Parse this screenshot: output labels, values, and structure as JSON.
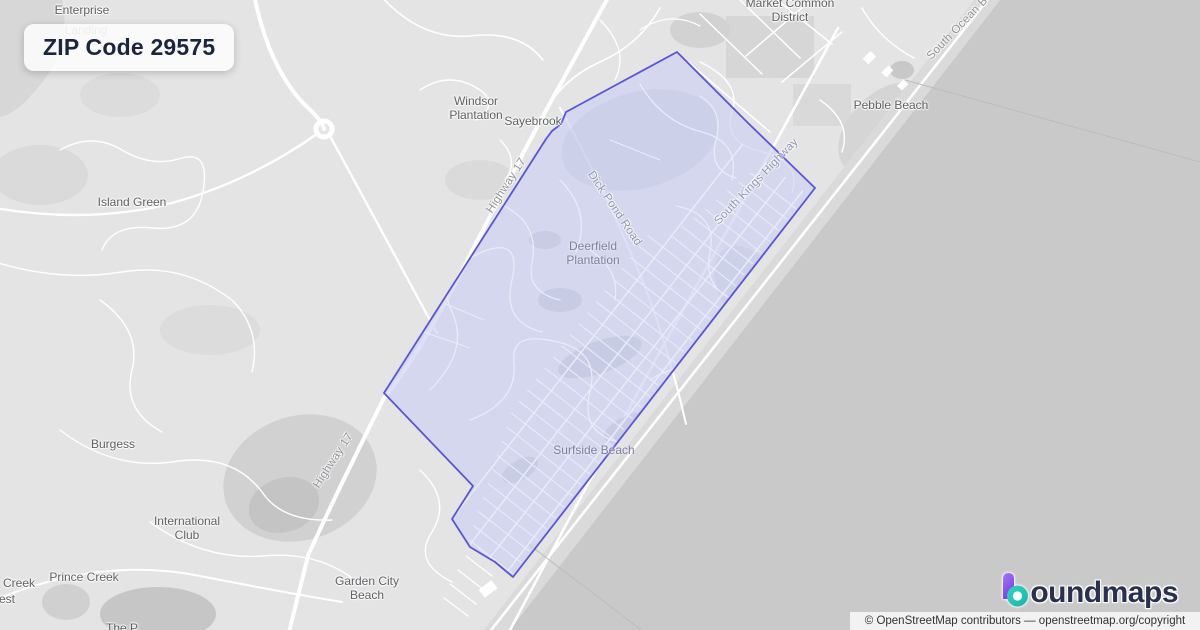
{
  "badge": {
    "title": "ZIP Code 29575"
  },
  "brand": {
    "wordmark": "oundmaps",
    "full_name": "boundmaps",
    "logo_colors": {
      "purple_top": "#a07cf0",
      "purple_bottom": "#7a3bea",
      "teal_light": "#35d3c0",
      "teal_dark": "#1db3ac"
    }
  },
  "attribution": {
    "text": "© OpenStreetMap contributors — openstreetmap.org/copyright"
  },
  "map": {
    "colors": {
      "land": "#e4e4e4",
      "ocean": "#c9c9c9",
      "beach": "#dadada",
      "road": "#ffffff",
      "zip_fill": "rgba(203,208,242,0.66)",
      "zip_border": "#5a55d8"
    },
    "zip_boundary_points": [
      [
        677,
        52
      ],
      [
        746,
        121
      ],
      [
        815,
        188
      ],
      [
        513,
        577
      ],
      [
        495,
        562
      ],
      [
        470,
        547
      ],
      [
        452,
        519
      ],
      [
        473,
        486
      ],
      [
        384,
        393
      ],
      [
        546,
        139
      ],
      [
        552,
        131
      ],
      [
        561,
        124
      ],
      [
        566,
        112
      ]
    ],
    "labels": [
      {
        "id": "enterprise",
        "text": "Enterprise",
        "x": 82,
        "y": 11,
        "rot": 0,
        "cls": ""
      },
      {
        "id": "landing",
        "text": "Landing",
        "x": 86,
        "y": 31,
        "rot": 0,
        "cls": "lbl-faded"
      },
      {
        "id": "windsor-plantation",
        "text": "Windsor\nPlantation",
        "x": 476,
        "y": 109,
        "rot": 0,
        "cls": ""
      },
      {
        "id": "sayebrook",
        "text": "Sayebrook",
        "x": 533,
        "y": 122,
        "rot": 0,
        "cls": ""
      },
      {
        "id": "market-common-district",
        "text": "Market Common\nDistrict",
        "x": 790,
        "y": 11,
        "rot": 0,
        "cls": ""
      },
      {
        "id": "pebble-beach",
        "text": "Pebble Beach",
        "x": 891,
        "y": 106,
        "rot": 0,
        "cls": ""
      },
      {
        "id": "island-green",
        "text": "Island Green",
        "x": 132,
        "y": 203,
        "rot": 0,
        "cls": ""
      },
      {
        "id": "deerfield-plantation",
        "text": "Deerfield\nPlantation",
        "x": 593,
        "y": 254,
        "rot": 0,
        "cls": "lbl-inpoly"
      },
      {
        "id": "surfside-beach",
        "text": "Surfside Beach",
        "x": 594,
        "y": 451,
        "rot": 0,
        "cls": "lbl-inpoly"
      },
      {
        "id": "burgess",
        "text": "Burgess",
        "x": 113,
        "y": 445,
        "rot": 0,
        "cls": ""
      },
      {
        "id": "international-club",
        "text": "International\nClub",
        "x": 187,
        "y": 529,
        "rot": 0,
        "cls": ""
      },
      {
        "id": "prince-creek",
        "text": "Prince Creek",
        "x": 84,
        "y": 578,
        "rot": 0,
        "cls": ""
      },
      {
        "id": "creek-partial",
        "text": "Creek",
        "x": 19,
        "y": 584,
        "rot": 0,
        "cls": ""
      },
      {
        "id": "est-partial",
        "text": "est",
        "x": 7,
        "y": 600,
        "rot": 0,
        "cls": ""
      },
      {
        "id": "garden-city-beach",
        "text": "Garden City\nBeach",
        "x": 367,
        "y": 589,
        "rot": 0,
        "cls": ""
      },
      {
        "id": "the-p-partial",
        "text": "The P",
        "x": 122,
        "y": 629,
        "rot": 0,
        "cls": ""
      },
      {
        "id": "highway-17-north",
        "text": "Highway 17",
        "x": 507,
        "y": 186,
        "rot": -57,
        "cls": "lbl-road"
      },
      {
        "id": "highway-17-south",
        "text": "Highway 17",
        "x": 334,
        "y": 461,
        "rot": -57,
        "cls": "lbl-road"
      },
      {
        "id": "dick-pond-road",
        "text": "Dick Pond Road",
        "x": 614,
        "y": 209,
        "rot": 56,
        "cls": "lbl-road lbl-inpoly-road"
      },
      {
        "id": "south-kings-highway",
        "text": "South Kings Highway",
        "x": 757,
        "y": 182,
        "rot": -46,
        "cls": "lbl-road lbl-inpoly-road"
      },
      {
        "id": "south-ocean-blvd",
        "text": "South Ocean B",
        "x": 958,
        "y": 29,
        "rot": -46,
        "cls": "lbl-road"
      }
    ]
  }
}
